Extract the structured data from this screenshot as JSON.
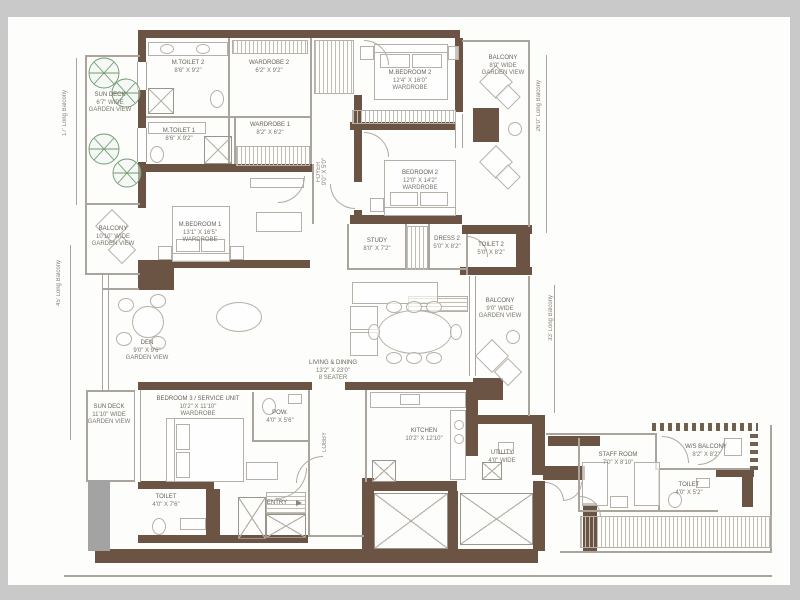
{
  "colors": {
    "wall": "#6b5444",
    "frame": "#c9c9c9",
    "line": "#a9a49c",
    "tree": "#6f9b6f",
    "text": "#7b766d"
  },
  "dims_labels": {
    "left_top": "17' Long Balcony",
    "left_bottom": "45' Long Balcony",
    "right_top": "26'0\" Long Balcony",
    "right_bottom": "33' Long Balcony"
  },
  "rooms": {
    "sun_deck_top": {
      "name": "SUN DECK",
      "dims": "6'7\" WIDE",
      "note": "GARDEN VIEW"
    },
    "m_toilet_2": {
      "name": "M.TOILET 2",
      "dims": "8'6\" X 9'2\""
    },
    "wardrobe_2": {
      "name": "WARDROBE 2",
      "dims": "6'2\" X 9'2\""
    },
    "m_bedroom_2": {
      "name": "M.BEDROOM 2",
      "dims": "12'4\" X 16'0\"",
      "note": "WARDROBE"
    },
    "balcony_top_right": {
      "name": "BALCONY",
      "dims": "8'0\" WIDE",
      "note": "GARDEN VIEW"
    },
    "m_toilet_1": {
      "name": "M.TOILET 1",
      "dims": "8'6\" X 9'2\""
    },
    "wardrobe_1": {
      "name": "WARDROBE 1",
      "dims": "8'2\" X 6'2\""
    },
    "foyer": {
      "name": "FOYER",
      "dims": "9'0\" X 5'0\""
    },
    "bedroom_2": {
      "name": "BEDROOM 2",
      "dims": "12'0\" X 14'2\"",
      "note": "WARDROBE"
    },
    "m_bedroom_1": {
      "name": "M.BEDROOM 1",
      "dims": "13'1\" X 16'5\"",
      "note": "WARDROBE"
    },
    "balcony_left": {
      "name": "BALCONY",
      "dims": "10'10\" WIDE",
      "note": "GARDEN VIEW"
    },
    "study": {
      "name": "STUDY",
      "dims": "8'0\" X 7'2\""
    },
    "dress_2": {
      "name": "DRESS 2",
      "dims": "5'0\" X 8'2\""
    },
    "toilet_2": {
      "name": "TOILET 2",
      "dims": "5'0\" X 8'2\""
    },
    "den": {
      "name": "DEN",
      "dims": "9'0\" X 9'6\"",
      "note": "GARDEN VIEW"
    },
    "living_dining": {
      "name": "LIVING & DINING",
      "dims": "13'2\" X 23'0\"",
      "note": "8 SEATER"
    },
    "balcony_right": {
      "name": "BALCONY",
      "dims": "9'0\" WIDE",
      "note": "GARDEN VIEW"
    },
    "sun_deck_bottom": {
      "name": "SUN DECK",
      "dims": "11'10\" WIDE",
      "note": "GARDEN VIEW"
    },
    "bedroom_3": {
      "name": "BEDROOM 3 / SERVICE UNIT",
      "dims": "10'2\" X 11'10\"",
      "note": "WARDROBE"
    },
    "powder": {
      "name": "POW.",
      "dims": "4'0\" X 5'6\""
    },
    "toilet_3": {
      "name": "TOILET",
      "dims": "4'0\" X 7'6\""
    },
    "lobby": {
      "name": "LOBBY"
    },
    "entry": {
      "name": "ENTRY"
    },
    "kitchen": {
      "name": "KITCHEN",
      "dims": "10'2\" X 12'10\""
    },
    "utility": {
      "name": "UTILITY",
      "dims": "4'0\" WIDE"
    },
    "staff_room": {
      "name": "STAFF ROOM",
      "dims": "7'0\" X 8'10\""
    },
    "ws_balcony": {
      "name": "W/S BALCONY",
      "dims": "8'2\" X 8'2\""
    },
    "staff_toilet": {
      "name": "TOILET",
      "dims": "4'0\" X 5'2\""
    }
  }
}
